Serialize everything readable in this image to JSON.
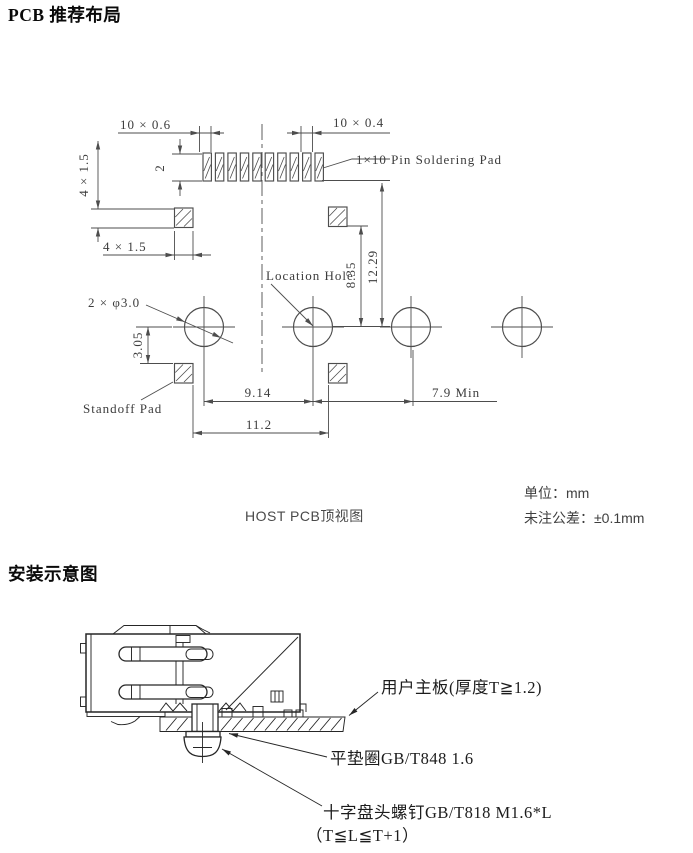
{
  "titles": {
    "section1": "PCB 推荐布局",
    "section2": "安装示意图"
  },
  "pcb": {
    "caption": "HOST PCB顶视图",
    "unit_note": "单位：mm",
    "tolerance_note": "未注公差：±0.1mm",
    "labels": {
      "pin_pad": "1×10 Pin Soldering Pad",
      "location_hole": "Location Hole",
      "standoff_pad": "Standoff Pad"
    },
    "dims": {
      "pad_w": "10 × 0.6",
      "pad_gap": "10 × 0.4",
      "pad_h": "2",
      "left_v": "4 × 1.5",
      "left_h": "4 × 1.5",
      "hole": "2 × φ3.0",
      "d835": "8.35",
      "d1229": "12.29",
      "d305": "3.05",
      "d914": "9.14",
      "d112": "11.2",
      "d79": "7.9 Min"
    }
  },
  "mount": {
    "labels": {
      "board": "用户主板(厚度T≧1.2)",
      "washer": "平垫圈GB/T848 1.6",
      "screw1": "十字盘头螺钉GB/T818 M1.6*L",
      "screw2": "（T≦L≦T+1）"
    }
  }
}
